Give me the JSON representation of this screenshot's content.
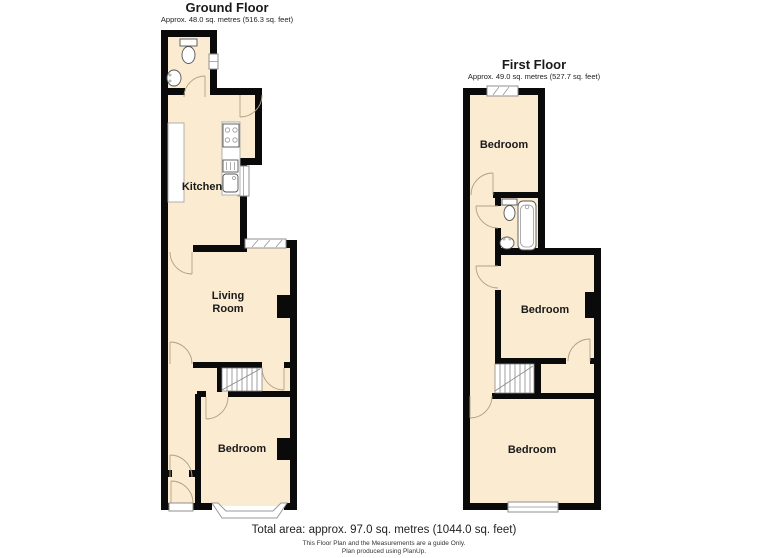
{
  "ground_floor": {
    "title": "Ground Floor",
    "subtitle": "Approx. 48.0 sq. metres (516.3 sq. feet)",
    "labels": {
      "kitchen": "Kitchen",
      "living_line1": "Living",
      "living_line2": "Room",
      "bedroom": "Bedroom"
    },
    "fixtures": [
      "toilet",
      "basin",
      "kitchen-counters",
      "hob",
      "sink-drainer",
      "stairs",
      "bay-window",
      "front-door"
    ]
  },
  "first_floor": {
    "title": "First Floor",
    "subtitle": "Approx. 49.0 sq. metres (527.7 sq. feet)",
    "labels": {
      "bedroom_top": "Bedroom",
      "bedroom_middle": "Bedroom",
      "bedroom_bottom": "Bedroom"
    },
    "fixtures": [
      "toilet",
      "bath",
      "basin",
      "stairs"
    ]
  },
  "footer": {
    "total_area": "Total area: approx. 97.0 sq. metres (1044.0 sq. feet)",
    "disclaimer": "This Floor Plan and the Measurements are a guide Only.",
    "credit": "Plan produced using PlanUp."
  },
  "colors": {
    "wall": "#0a0a0a",
    "room_fill": "#faebd1",
    "window_fill": "#ffffff",
    "frame_stroke": "#8f8f8f",
    "fixture_stroke": "#555555",
    "door_arc": "#b3a285",
    "text": "#1a1a1a"
  }
}
